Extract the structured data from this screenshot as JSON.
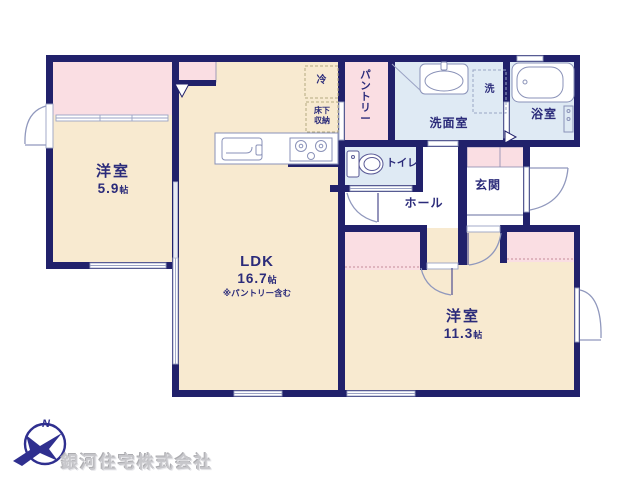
{
  "plan": {
    "rooms": {
      "bedroom1": {
        "name": "洋室",
        "size": "5.9",
        "unit": "帖"
      },
      "ldk": {
        "name": "LDK",
        "size": "16.7",
        "unit": "帖",
        "note": "※パントリー含む"
      },
      "bedroom2": {
        "name": "洋室",
        "size": "11.3",
        "unit": "帖"
      },
      "washroom": {
        "name": "洗面室"
      },
      "bathroom": {
        "name": "浴室"
      },
      "toilet": {
        "name": "トイレ"
      },
      "hall": {
        "name": "ホール"
      },
      "entrance": {
        "name": "玄関"
      },
      "pantry": {
        "name": "パントリー"
      }
    },
    "storage": {
      "refrigerator": "冷",
      "underfloor_line1": "床下",
      "underfloor_line2": "収納",
      "washer": "洗"
    },
    "colors": {
      "wall": "#21216b",
      "room_floor": "#f8ead0",
      "closet": "#fadee3",
      "wet_area": "#dfeaf4",
      "label": "#2b2b7a",
      "logo": "#2f2f8f",
      "company_text": "#c7c7cb"
    }
  },
  "logo": {
    "company": "銀河住宅株式会社",
    "compass_letter": "N"
  }
}
